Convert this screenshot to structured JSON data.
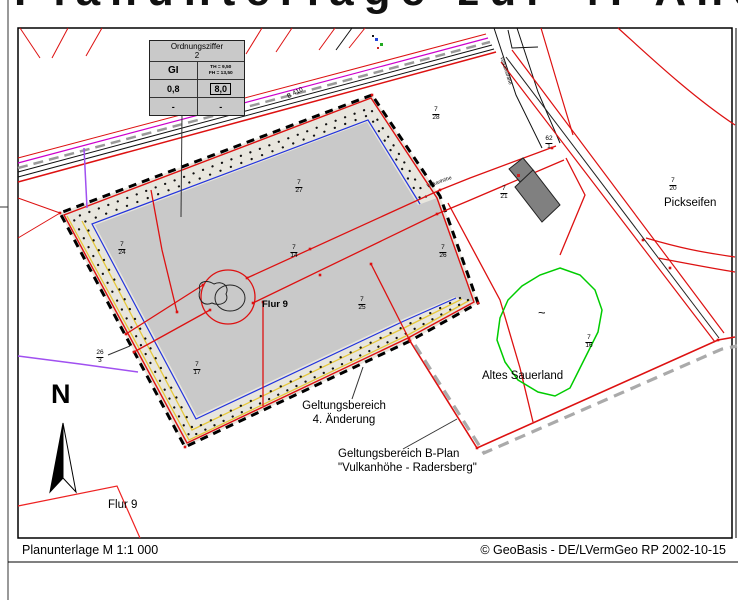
{
  "page": {
    "clipped_heading": "Planunterlage zur 4. Änderung",
    "footer": {
      "left": "Planunterlage M 1:1 000",
      "right": "© GeoBasis - DE/LVermGeo RP 2002-10-15"
    }
  },
  "legend": {
    "title_line1": "Ordnungsziffer",
    "title_line2": "2",
    "cell_gi": "GI",
    "cell_th": "TH = 9,50",
    "cell_fh": "FH = 13,50",
    "cell_grz": "0,8",
    "cell_height": "8,0",
    "cell_dash_left": "-",
    "cell_dash_right": "-"
  },
  "map": {
    "labels": {
      "b410": "B 410",
      "street_top": "Vulkanstraße",
      "street_mid": "Vulkanhöhe",
      "pickseifen": "Pickseifen",
      "altes_sauerland": "Altes Sauerland",
      "flur9_center": "Flur 9",
      "flur9_bottom": "Flur 9",
      "geltungsbereich_line1": "Geltungsbereich",
      "geltungsbereich_line2": "4. Änderung",
      "bplan_line1": "Geltungsbereich B-Plan",
      "bplan_line2": "\"Vulkanhöhe - Radersberg\"",
      "north": "N",
      "biotope_mark": "~"
    },
    "parcels": [
      {
        "num": "7",
        "den": "27"
      },
      {
        "num": "7",
        "den": "24"
      },
      {
        "num": "7",
        "den": "14"
      },
      {
        "num": "7",
        "den": "26"
      },
      {
        "num": "7",
        "den": "25"
      },
      {
        "num": "7",
        "den": "17"
      },
      {
        "num": "7",
        "den": "28"
      },
      {
        "num": "7",
        "den": "21"
      },
      {
        "num": "7",
        "den": "20"
      },
      {
        "num": "7",
        "den": "16"
      },
      {
        "num": "26",
        "den": "3"
      },
      {
        "num": "62",
        "den": "1"
      }
    ],
    "colors": {
      "plan_fill": "#c9c9c9",
      "strip_fill": "#e8e6de",
      "boundary_red": "#dd1111",
      "dash_black": "#000000",
      "blue_line": "#2233dd",
      "yellow_line": "#e6c83c",
      "violet": "#a050f0",
      "magenta": "#cc00cc",
      "green_outline": "#00cc00",
      "bplan_dash_gray": "#aaaaaa",
      "building_fill": "#808080"
    }
  }
}
